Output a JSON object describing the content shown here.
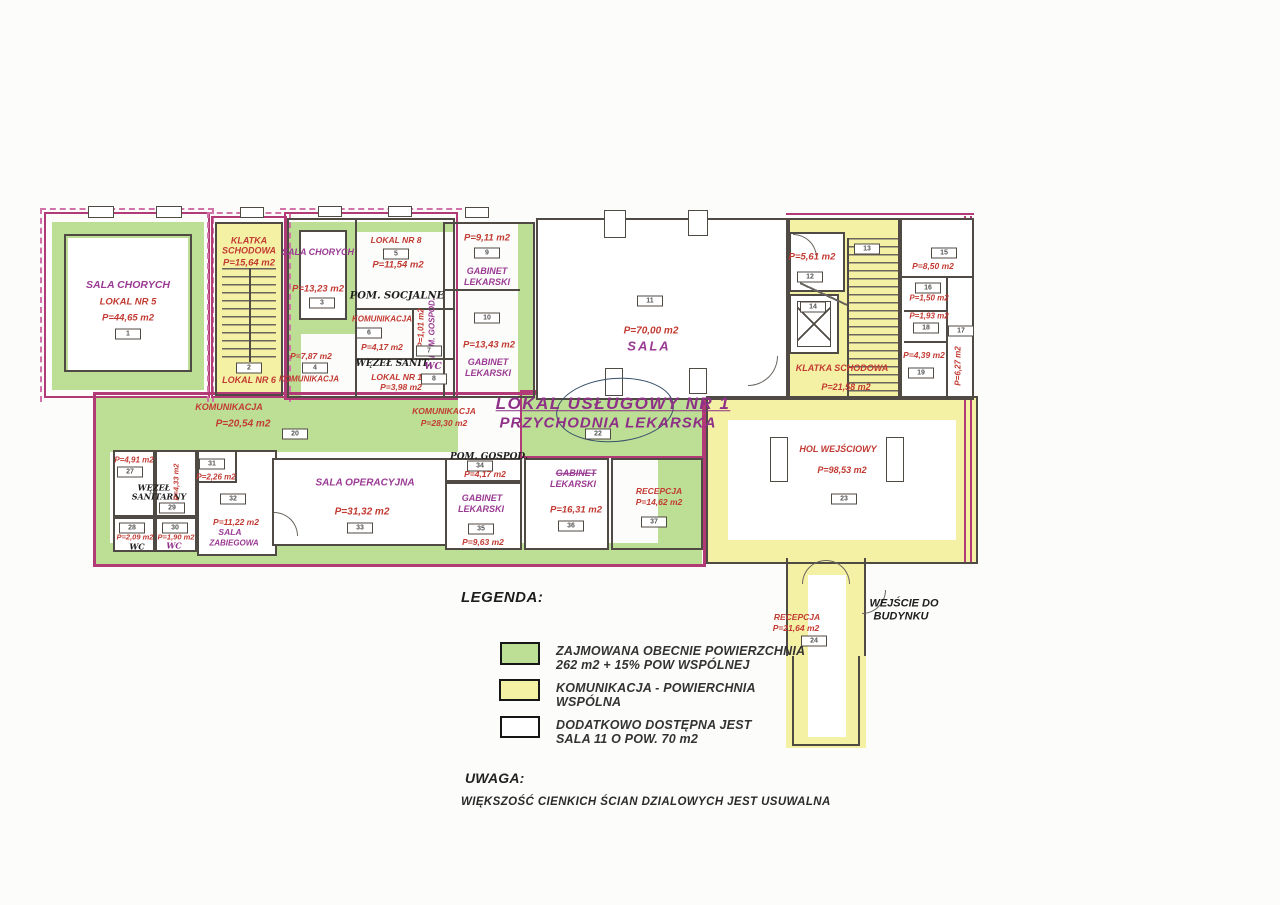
{
  "colors": {
    "occupied_green": "#bcdf95",
    "shared_yellow": "#f5f1a4",
    "outline_magenta": "#b23a77",
    "label_red": "#c23a32",
    "label_purple": "#9a3a93"
  },
  "rooms": {
    "r1": {
      "name": "SALA CHORYCH",
      "lokal": "LOKAL NR 5",
      "area": "P=44,65 m2",
      "num": "1"
    },
    "r2": {
      "name": "KLATKA SCHODOWA",
      "area": "P=15,64 m2",
      "num": "2",
      "lokal": "LOKAL NR 6"
    },
    "r3": {
      "name": "SALA CHORYCH",
      "area": "P=13,23 m2",
      "num": "3"
    },
    "r4": {
      "area": "P=7,87 m2",
      "num": "4",
      "name": "KOMUNIKACJA"
    },
    "r5": {
      "lokal": "LOKAL NR 8",
      "num": "5",
      "area": "P=11,54 m2",
      "hand": "POM. SOCJALNE"
    },
    "r6": {
      "name": "KOMUNIKACJA",
      "num": "6",
      "area": "P=4,17 m2"
    },
    "r7": {
      "area": "P=1,01 m2",
      "name": "POM. GOSPOD.",
      "num": "7"
    },
    "r8": {
      "hand": "WĘZEŁ SANIT.",
      "wc": "WC",
      "lokal": "LOKAL NR 10",
      "area": "P=3,98 m2",
      "num": "8"
    },
    "r9": {
      "area": "P=9,11 m2",
      "num": "9",
      "name1": "GABINET",
      "name2": "LEKARSKI"
    },
    "r10": {
      "num": "10",
      "area": "P=13,43 m2",
      "name1": "GABINET",
      "name2": "LEKARSKI"
    },
    "r11": {
      "num": "11",
      "area": "P=70,00 m2",
      "name": "SALA"
    },
    "r12": {
      "area": "P=5,61 m2",
      "num": "12"
    },
    "r13": {
      "num": "13"
    },
    "r14": {
      "num": "14"
    },
    "ks2": {
      "name": "KLATKA SCHODOWA",
      "area": "P=21,58 m2"
    },
    "r15": {
      "num": "15",
      "area": "P=8,50 m2"
    },
    "r16": {
      "num": "16",
      "area": "P=1,50 m2"
    },
    "r17": {
      "num": "17",
      "area": "P=6,27 m2"
    },
    "r18": {
      "area": "P=1,93 m2",
      "num": "18"
    },
    "r19": {
      "area": "P=4,39 m2",
      "num": "19"
    },
    "c20": {
      "name": "KOMUNIKACJA",
      "area": "P=20,54 m2",
      "num": "20"
    },
    "c21": {
      "name": "KOMUNIKACJA",
      "area": "P=28,30 m2"
    },
    "lokal1": {
      "line1": "LOKAL USŁUGOWY NR 1",
      "line2": "PRZYCHODNIA LEKARSKA",
      "num": "22"
    },
    "hol": {
      "name": "HOL WEJŚCIOWY",
      "area": "P=98,53 m2",
      "num": "23"
    },
    "r24": {
      "name": "RECEPCJA",
      "area": "P=21,64 m2",
      "num": "24"
    },
    "entrance": {
      "line1": "WEJŚCIE DO",
      "line2": "BUDYNKU"
    },
    "r27": {
      "area": "P=4,91 m2",
      "num": "27",
      "hand1": "WĘZEŁ",
      "hand2": "SANITARNY"
    },
    "r28": {
      "num": "28",
      "area": "P=2,09 m2",
      "wc": "WC"
    },
    "r29": {
      "area": "P=4,33 m2",
      "num": "29"
    },
    "r30": {
      "num": "30",
      "area": "P=1,90 m2",
      "wc": "WC"
    },
    "r31": {
      "num": "31",
      "area": "P=2,26 m2"
    },
    "r32": {
      "num": "32",
      "area": "P=11,22 m2",
      "name1": "SALA",
      "name2": "ZABIEGOWA"
    },
    "r33": {
      "name": "SALA OPERACYJNA",
      "area": "P=31,32 m2",
      "num": "33"
    },
    "r34": {
      "hand": "POM. GOSPOD.",
      "num": "34",
      "area": "P=4,17 m2"
    },
    "r35": {
      "name1": "GABINET",
      "name2": "LEKARSKI",
      "num": "35",
      "area": "P=9,63 m2"
    },
    "r36": {
      "name1": "GABINET",
      "name2": "LEKARSKI",
      "area": "P=16,31 m2",
      "num": "36"
    },
    "r37": {
      "name": "RECEPCJA",
      "area": "P=14,62 m2",
      "num": "37"
    }
  },
  "legend": {
    "title": "LEGENDA:",
    "items": [
      {
        "swatch": "green",
        "color": "#bcdf95",
        "line1": "ZAJMOWANA OBECNIE POWIERZCHNIA",
        "line2": "262 m2 + 15% POW WSPÓLNEJ"
      },
      {
        "swatch": "yellow",
        "color": "#f5f1a4",
        "line1": "KOMUNIKACJA - POWIERCHNIA",
        "line2": "WSPÓLNA"
      },
      {
        "swatch": "white",
        "color": "#ffffff",
        "line1": "DODATKOWO DOSTĘPNA JEST",
        "line2": "SALA 11 O POW. 70 m2"
      }
    ]
  },
  "note": {
    "title": "UWAGA:",
    "text": "WIĘKSZOŚĆ CIENKICH ŚCIAN DZIALOWYCH JEST USUWALNA"
  }
}
